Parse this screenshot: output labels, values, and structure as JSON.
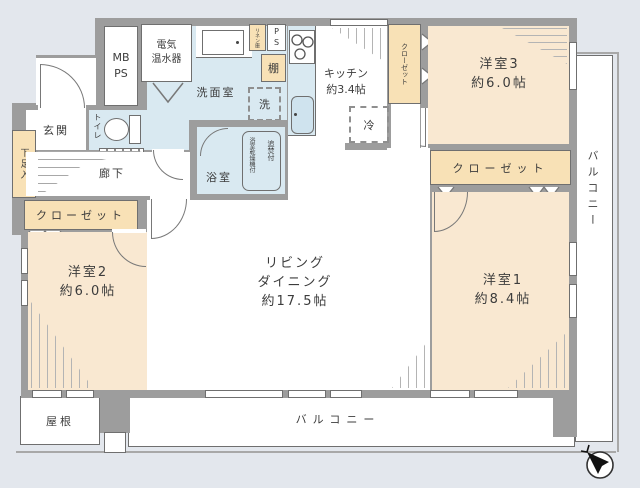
{
  "plan": {
    "living": "リビング\nダイニング\n約17.5帖",
    "room1": "洋室1\n約8.4帖",
    "room2": "洋室2\n約6.0帖",
    "room3": "洋室3\n約6.0帖",
    "kitchen": "キッチン\n約3.4帖",
    "washroom": "洗面室",
    "bathroom": "浴室",
    "bath_note_reheat": "追焚付",
    "bath_note_dryer": "浴室乾燥機付",
    "toilet": "トイレ",
    "entrance": "玄関",
    "corridor": "廊下",
    "shoe_cabinet": "下足入",
    "closet_left": "クローゼット",
    "closet_room3_side": "クローゼット",
    "closet_room3_bottom": "クローゼット",
    "shelf": "棚",
    "linen_cabinet": "リネン庫",
    "meter_pipe_space": "MB\nPS",
    "pipe_space": "P\nS",
    "water_heater": "電気\n温水器",
    "washing_machine": "洗",
    "refrigerator": "冷",
    "balcony_right": "バルコニー",
    "balcony_bottom": "バルコニー",
    "roof": "屋根"
  },
  "colors": {
    "wall": "#9d9d9d",
    "room_fill": "#f9e8d1",
    "closet_fill": "#f8e1b6",
    "wet_fill": "#d9e9f1",
    "background": "#e3e7ed",
    "outline": "#6f6f6f"
  }
}
